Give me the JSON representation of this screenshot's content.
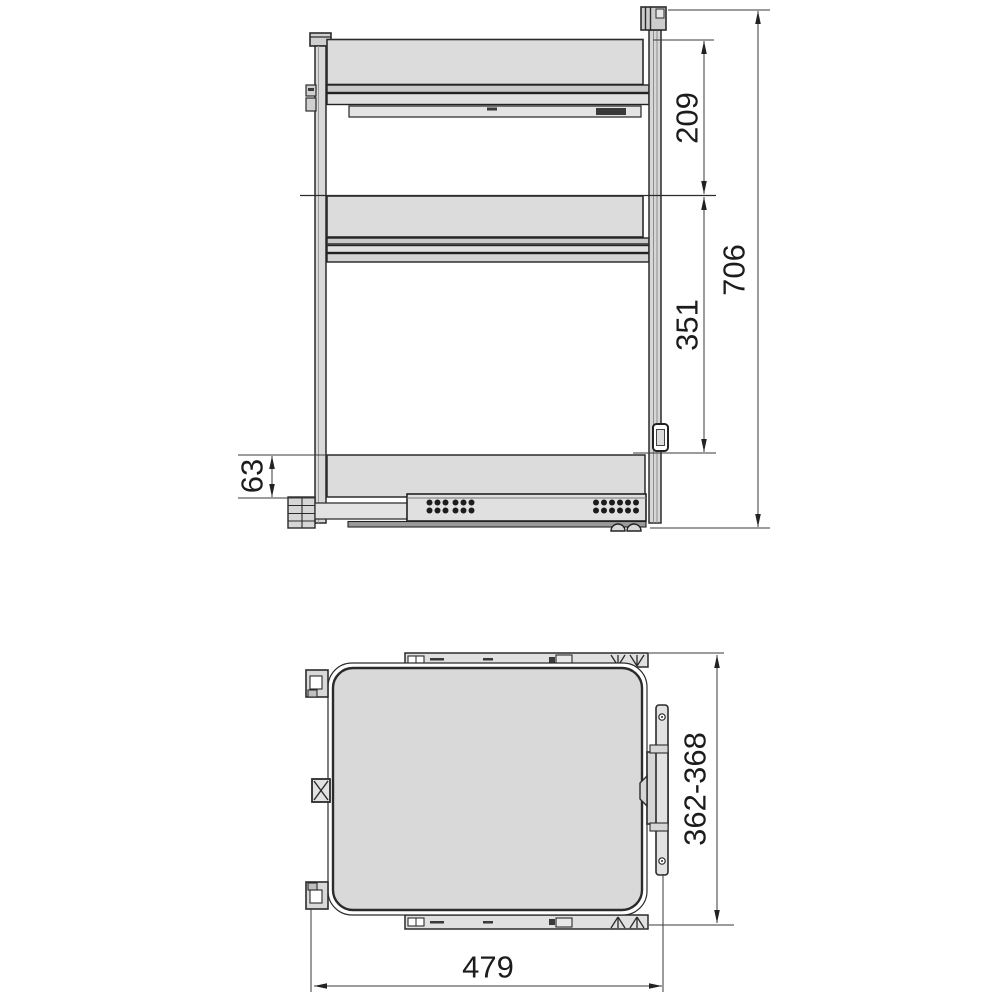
{
  "image": {
    "type": "technical-dimension-drawing",
    "subject": "pull-out cabinet basket unit, front elevation and plan view",
    "background": "#ffffff"
  },
  "colors": {
    "outline": "#2b2b2b",
    "panel_fill": "#dcdcdc",
    "band_fill": "#c9c9c9",
    "light_fill": "#e3e3e3",
    "rail_fill": "#d6d6d6",
    "dim_line": "#3a3a3a",
    "text": "#1c1c1c",
    "hole": "#1d1d1d"
  },
  "front_view": {
    "name": "front elevation",
    "dimensions": [
      {
        "id": "top-section-height",
        "label": "209"
      },
      {
        "id": "middle-section-height",
        "label": "351"
      },
      {
        "id": "total-height",
        "label": "706"
      },
      {
        "id": "bottom-section-height",
        "label": "63"
      }
    ]
  },
  "top_view": {
    "name": "plan view",
    "dimensions": [
      {
        "id": "depth-range",
        "label": "362-368"
      },
      {
        "id": "overall-width",
        "label": "479"
      }
    ]
  }
}
